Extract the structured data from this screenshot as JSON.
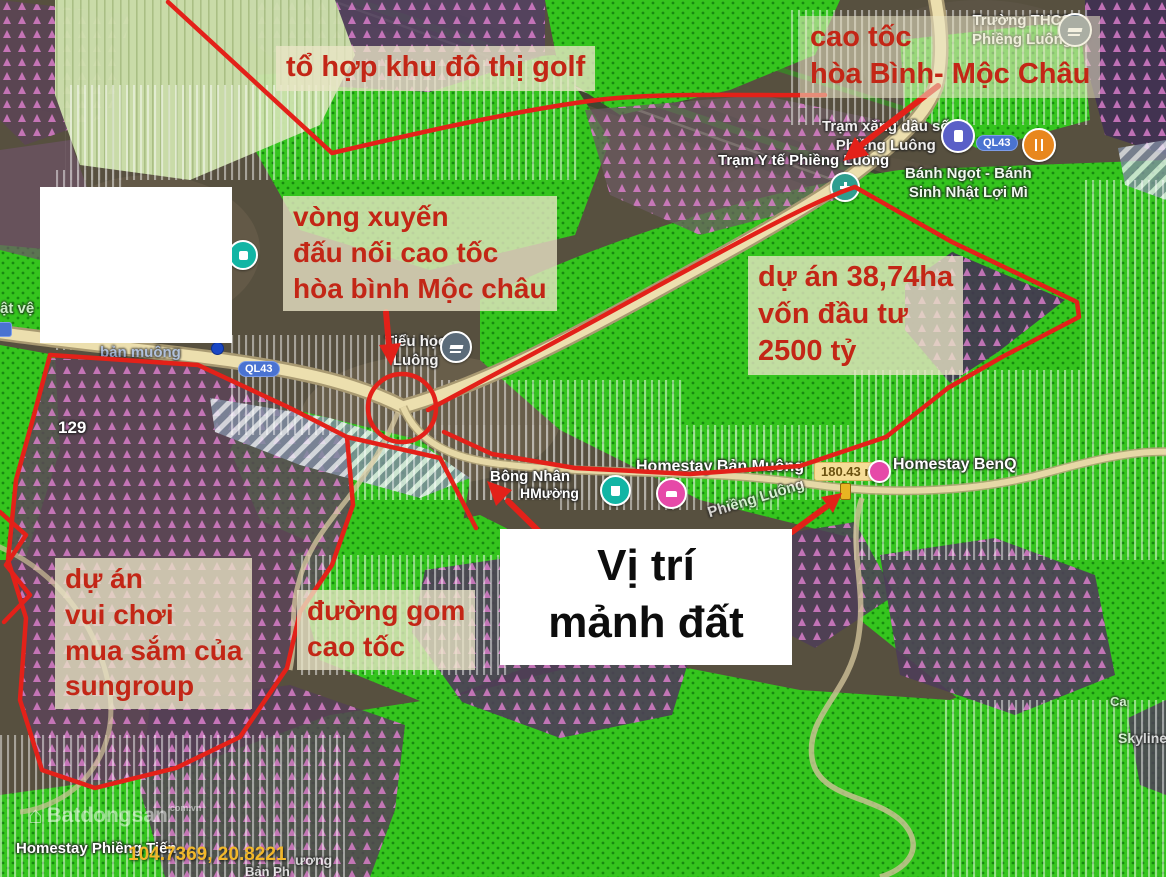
{
  "annotations": {
    "golf": "tổ hợp khu đô thị golf",
    "expressway": {
      "line1": "cao tốc",
      "line2": "hòa Bình- Mộc Châu"
    },
    "roundabout": {
      "line1": "vòng xuyến",
      "line2": "đấu nối cao tốc",
      "line3": "hòa bình Mộc châu"
    },
    "project": {
      "line1": "dự án 38,74ha",
      "line2": "vốn đầu tư",
      "line3": "2500 tỷ"
    },
    "sungroup": {
      "line1": "dự án",
      "line2": "vui chơi",
      "line3": "mua sắm của",
      "line4": "sungroup"
    },
    "frontage": {
      "line1": "đường gom",
      "line2": "cao tốc"
    },
    "location": {
      "line1": "Vị trí",
      "line2": "mảnh đất"
    }
  },
  "map_labels": {
    "school_thcs": {
      "line1": "Trường THCS",
      "line2": "Phiềng Luông"
    },
    "gas_station": {
      "line1": "Trạm xăng dầu số",
      "line2": "Phiềng Luông"
    },
    "health_station": "Trạm Y tế Phiềng Luông",
    "bakery": {
      "line1": "Bánh Ngọt - Bánh",
      "line2": "Sinh Nhật Lợi Mì"
    },
    "primary_school": {
      "line1": "Tiểu học",
      "line2": "Luông"
    },
    "homestay_ban_muong": "Homestay Bản Muông",
    "homestay_benq": "Homestay BenQ",
    "homestay_phieng_tien": "Homestay Phiềng Tiến",
    "store_bong_nhan": {
      "line1": "Bông Nhân",
      "line2": "HMường"
    },
    "road_phieng_luong": "Phiềng Luông",
    "road_ban_muong": "bản muông",
    "skyline": "Skyline",
    "ca_partial": "Ca",
    "left_edge_partial": "ật vệ",
    "plot_number": "129",
    "bottom_partial_1": "ương",
    "bottom_partial_2": "Bản Ph",
    "ql43": "QL43",
    "area_badge": "180.43 m²",
    "coordinates": "104.7369, 20.8221",
    "watermark": {
      "brand": "Batdongsan",
      "suffix": "com.vn",
      "house_glyph": "⌂"
    }
  },
  "colors": {
    "annotation_red": "#c32616",
    "overlay_red": "#e32119",
    "map_green": "#35c51e",
    "map_purple": "#54425f",
    "badge_blue": "#4a73d1",
    "area_badge_bg": "#f6dd96",
    "coordinates_yellow": "#f2b82a"
  }
}
